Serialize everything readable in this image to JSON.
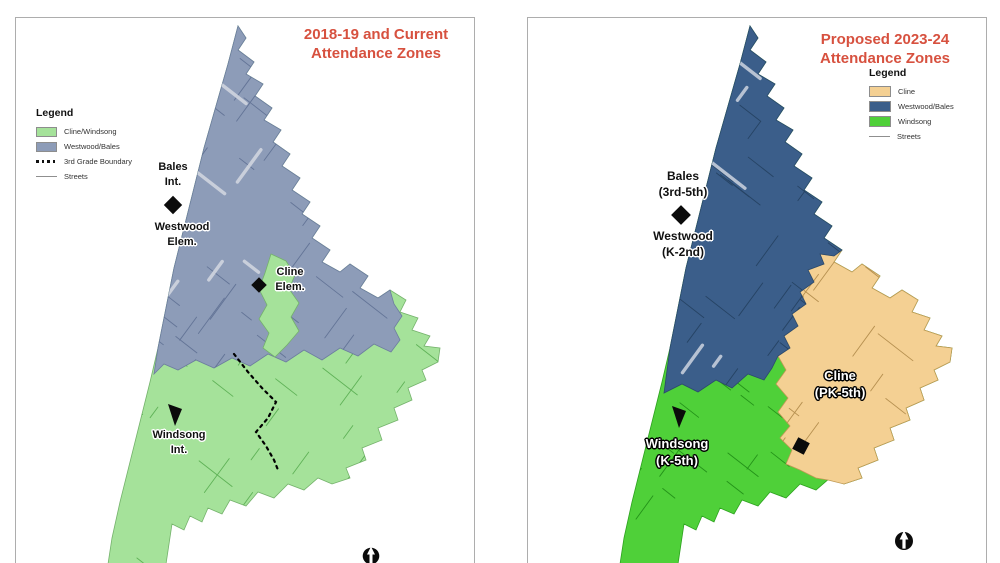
{
  "window": {
    "background": "#ffffff"
  },
  "colors": {
    "title_red": "#d7513f",
    "marker_black": "#0b0b0b",
    "left_zone_green": "#a5e29a",
    "left_zone_blue": "#8d9cb8",
    "right_zone_blue": "#3b5e8a",
    "right_zone_green": "#4fd039",
    "right_zone_tan": "#f4d093"
  },
  "left_map": {
    "title_line1": "2018-19 and Current",
    "title_line2": "Attendance Zones",
    "legend": {
      "title": "Legend",
      "items": [
        {
          "label": "Cline/Windsong",
          "swatch": "green-fill"
        },
        {
          "label": "Westwood/Bales",
          "swatch": "blue-fill"
        },
        {
          "label": "3rd Grade Boundary",
          "swatch": "dashed-boundary-line"
        },
        {
          "label": "Streets",
          "swatch": "thin-street-line"
        }
      ]
    },
    "schools": {
      "bales": {
        "line1": "Bales",
        "line2": "Int.",
        "marker": "diamond"
      },
      "westwood": {
        "line1": "Westwood",
        "line2": "Elem."
      },
      "cline": {
        "line1": "Cline",
        "line2": "Elem.",
        "marker": "diamond"
      },
      "windsong": {
        "line1": "Windsong",
        "line2": "Int.",
        "marker": "triangle"
      }
    },
    "icons": [
      "north-arrow-icon"
    ]
  },
  "right_map": {
    "title_line1": "Proposed 2023-24",
    "title_line2": "Attendance Zones",
    "legend": {
      "title": "Legend",
      "items": [
        {
          "label": "Cline",
          "swatch": "tan-fill"
        },
        {
          "label": "Westwood/Bales",
          "swatch": "blue-fill"
        },
        {
          "label": "Windsong",
          "swatch": "green-fill"
        },
        {
          "label": "Streets",
          "swatch": "thin-street-line"
        }
      ]
    },
    "schools": {
      "bales": {
        "line1": "Bales",
        "line2": "(3rd-5th)",
        "marker": "diamond"
      },
      "westwood": {
        "line1": "Westwood",
        "line2": "(K-2nd)"
      },
      "windsong": {
        "line1": "Windsong",
        "line2": "(K-5th)",
        "marker": "triangle"
      },
      "cline": {
        "line1": "Cline",
        "line2": "(PK-5th)",
        "marker": "square"
      }
    },
    "icons": [
      "north-arrow-icon"
    ]
  }
}
